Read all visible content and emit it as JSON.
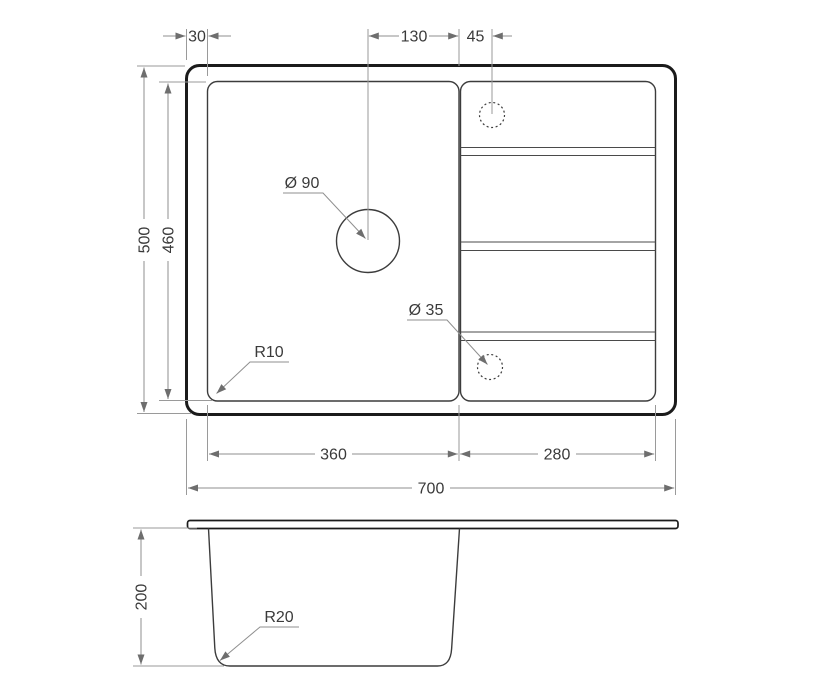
{
  "page": {
    "background": "#ffffff",
    "description": "Technical dimension drawing of a kitchen sink: top view with bowl, drainboard and holes, plus cross-section view below"
  },
  "colors": {
    "outline": "#1b1b1b",
    "feature_line": "#3c3c3c",
    "dimension_line": "#8f8f8f",
    "dimension_text": "#3a3a3a",
    "background": "#ffffff"
  },
  "labels": {
    "rim_offset": "30",
    "faucet_to_divider": "130",
    "divider_to_drain": "45",
    "overall_depth": "500",
    "bowl_depth": "460",
    "bowl_width": "360",
    "drainboard_width": "280",
    "overall_width": "700",
    "faucet_hole_diameter": "Ø 90",
    "drain_hole_diameter": "Ø 35",
    "bowl_corner_radius": "R10",
    "section_depth": "200",
    "section_bottom_radius": "R20"
  }
}
